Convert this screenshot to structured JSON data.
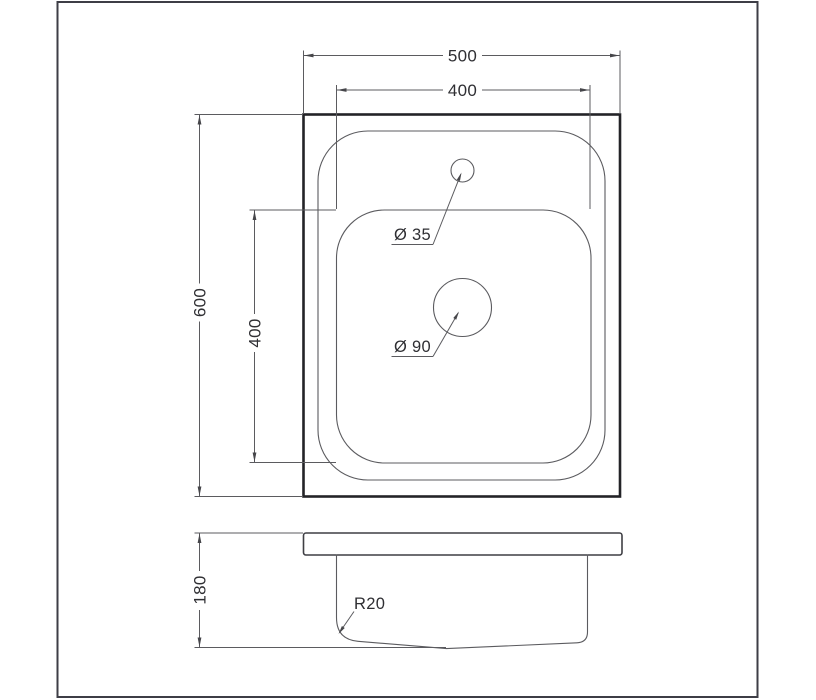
{
  "drawing": {
    "kind": "sink-technical-drawing",
    "top_view": {
      "width_label": "500",
      "inner_width_label": "400",
      "height_label": "600",
      "inner_height_label": "400",
      "faucet_label": "Ø 35",
      "drain_label": "Ø 90"
    },
    "side_view": {
      "depth_label": "180",
      "radius_label": "R20"
    },
    "colors": {
      "background": "#ffffff",
      "frame": "#3e3e46",
      "heavy_line": "#232327",
      "thin_line": "#5b5b5f",
      "text": "#2f2f33"
    }
  }
}
